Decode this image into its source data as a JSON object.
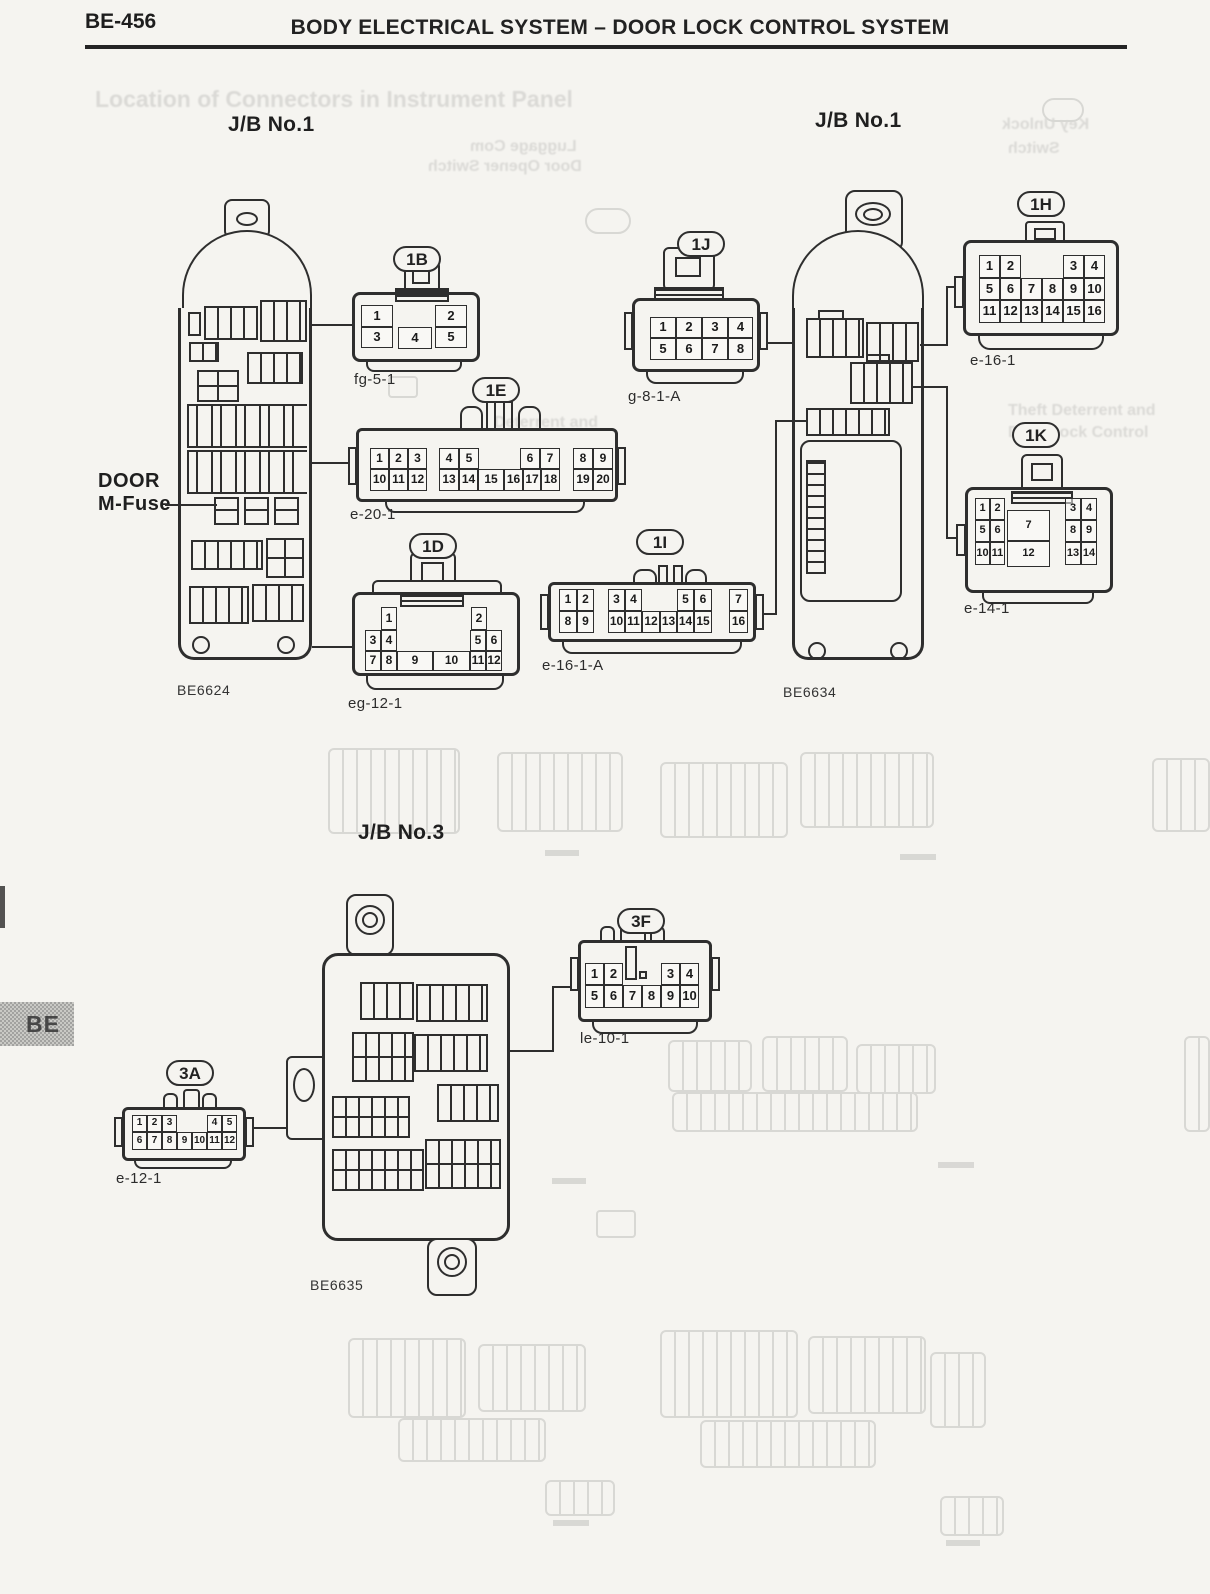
{
  "page": {
    "code": "BE-456",
    "title": "BODY ELECTRICAL SYSTEM – DOOR LOCK CONTROL SYSTEM",
    "side_tab": "BE"
  },
  "sections": {
    "jb1_left": "J/B No.1",
    "jb1_right": "J/B No.1",
    "jb3": "J/B No.3"
  },
  "annotations": {
    "door_mfuse_line1": "DOOR",
    "door_mfuse_line2": "M-Fuse"
  },
  "blocks": {
    "left": {
      "caption": "BE6624"
    },
    "right": {
      "caption": "BE6634"
    },
    "bottom": {
      "caption": "BE6635"
    }
  },
  "connectors": [
    {
      "id": "1B",
      "code": "fg-5-1",
      "pins": [
        [
          "1",
          361,
          305,
          32,
          22
        ],
        [
          "2",
          435,
          305,
          32,
          22
        ],
        [
          "3",
          361,
          327,
          32,
          21
        ],
        [
          "4",
          398,
          327,
          34,
          22
        ],
        [
          "5",
          435,
          327,
          32,
          21
        ]
      ]
    },
    {
      "id": "1E",
      "code": "e-20-1",
      "pins": [
        [
          "1",
          370,
          448,
          19,
          21
        ],
        [
          "2",
          389,
          448,
          19,
          21
        ],
        [
          "3",
          408,
          448,
          19,
          21
        ],
        [
          "4",
          439,
          448,
          20,
          21
        ],
        [
          "5",
          459,
          448,
          20,
          21
        ],
        [
          "6",
          520,
          448,
          20,
          21
        ],
        [
          "7",
          540,
          448,
          20,
          21
        ],
        [
          "8",
          573,
          448,
          20,
          21
        ],
        [
          "9",
          593,
          448,
          20,
          21
        ],
        [
          "10",
          370,
          469,
          19,
          22
        ],
        [
          "11",
          389,
          469,
          19,
          22
        ],
        [
          "12",
          408,
          469,
          19,
          22
        ],
        [
          "13",
          439,
          469,
          20,
          22
        ],
        [
          "14",
          459,
          469,
          19,
          22
        ],
        [
          "15",
          478,
          469,
          26,
          22
        ],
        [
          "16",
          504,
          469,
          19,
          22
        ],
        [
          "17",
          523,
          469,
          18,
          22
        ],
        [
          "18",
          541,
          469,
          19,
          22
        ],
        [
          "19",
          573,
          469,
          20,
          22
        ],
        [
          "20",
          593,
          469,
          20,
          22
        ]
      ]
    },
    {
      "id": "1D",
      "code": "eg-12-1",
      "pins": [
        [
          "1",
          381,
          607,
          16,
          23
        ],
        [
          "2",
          471,
          607,
          16,
          23
        ],
        [
          "3",
          365,
          630,
          16,
          21
        ],
        [
          "4",
          381,
          630,
          16,
          21
        ],
        [
          "5",
          470,
          630,
          16,
          21
        ],
        [
          "6",
          486,
          630,
          16,
          21
        ],
        [
          "7",
          365,
          651,
          16,
          20
        ],
        [
          "8",
          381,
          651,
          16,
          20
        ],
        [
          "9",
          397,
          651,
          36,
          20
        ],
        [
          "10",
          433,
          651,
          37,
          20
        ],
        [
          "11",
          470,
          651,
          16,
          20
        ],
        [
          "12",
          486,
          651,
          16,
          20
        ]
      ]
    },
    {
      "id": "1J",
      "code": "g-8-1-A",
      "pins": [
        [
          "1",
          650,
          317,
          26,
          21
        ],
        [
          "2",
          676,
          317,
          26,
          21
        ],
        [
          "3",
          702,
          317,
          26,
          21
        ],
        [
          "4",
          728,
          317,
          25,
          21
        ],
        [
          "5",
          650,
          338,
          26,
          22
        ],
        [
          "6",
          676,
          338,
          26,
          22
        ],
        [
          "7",
          702,
          338,
          26,
          22
        ],
        [
          "8",
          728,
          338,
          25,
          22
        ]
      ]
    },
    {
      "id": "1I",
      "code": "e-16-1-A",
      "pins": [
        [
          "1",
          559,
          589,
          18,
          22
        ],
        [
          "2",
          577,
          589,
          17,
          22
        ],
        [
          "8",
          559,
          611,
          18,
          22
        ],
        [
          "9",
          577,
          611,
          17,
          22
        ],
        [
          "3",
          608,
          589,
          17,
          22
        ],
        [
          "4",
          625,
          589,
          17,
          22
        ],
        [
          "5",
          677,
          589,
          17,
          22
        ],
        [
          "6",
          694,
          589,
          18,
          22
        ],
        [
          "10",
          608,
          611,
          17,
          22
        ],
        [
          "11",
          625,
          611,
          17,
          22
        ],
        [
          "12",
          642,
          611,
          18,
          22
        ],
        [
          "13",
          660,
          611,
          17,
          22
        ],
        [
          "14",
          677,
          611,
          17,
          22
        ],
        [
          "15",
          694,
          611,
          18,
          22
        ],
        [
          "7",
          729,
          589,
          19,
          22
        ],
        [
          "16",
          729,
          611,
          19,
          22
        ]
      ]
    },
    {
      "id": "1H",
      "code": "e-16-1",
      "pins": [
        [
          "1",
          979,
          255,
          21,
          23
        ],
        [
          "2",
          1000,
          255,
          21,
          23
        ],
        [
          "3",
          1063,
          255,
          21,
          23
        ],
        [
          "4",
          1084,
          255,
          21,
          23
        ],
        [
          "5",
          979,
          278,
          21,
          22
        ],
        [
          "6",
          1000,
          278,
          21,
          22
        ],
        [
          "7",
          1021,
          278,
          21,
          22
        ],
        [
          "8",
          1042,
          278,
          21,
          22
        ],
        [
          "9",
          1063,
          278,
          21,
          22
        ],
        [
          "10",
          1084,
          278,
          21,
          22
        ],
        [
          "11",
          979,
          300,
          21,
          23
        ],
        [
          "12",
          1000,
          300,
          21,
          23
        ],
        [
          "13",
          1021,
          300,
          21,
          23
        ],
        [
          "14",
          1042,
          300,
          21,
          23
        ],
        [
          "15",
          1063,
          300,
          21,
          23
        ],
        [
          "16",
          1084,
          300,
          21,
          23
        ]
      ]
    },
    {
      "id": "1K",
      "code": "e-14-1",
      "pins": [
        [
          "1",
          975,
          498,
          15,
          22
        ],
        [
          "2",
          990,
          498,
          15,
          22
        ],
        [
          "5",
          975,
          520,
          15,
          22
        ],
        [
          "6",
          990,
          520,
          15,
          22
        ],
        [
          "10",
          975,
          542,
          15,
          23
        ],
        [
          "11",
          990,
          542,
          15,
          23
        ],
        [
          "7",
          1007,
          510,
          43,
          31
        ],
        [
          "12",
          1007,
          541,
          43,
          26
        ],
        [
          "3",
          1065,
          498,
          16,
          22
        ],
        [
          "4",
          1081,
          498,
          16,
          22
        ],
        [
          "8",
          1065,
          520,
          16,
          22
        ],
        [
          "9",
          1081,
          520,
          16,
          22
        ],
        [
          "13",
          1065,
          542,
          16,
          23
        ],
        [
          "14",
          1081,
          542,
          16,
          23
        ]
      ]
    },
    {
      "id": "3F",
      "code": "le-10-1",
      "pins": [
        [
          "1",
          585,
          963,
          19,
          22
        ],
        [
          "2",
          604,
          963,
          19,
          22
        ],
        [
          "3",
          661,
          963,
          19,
          22
        ],
        [
          "4",
          680,
          963,
          19,
          22
        ],
        [
          "5",
          585,
          985,
          19,
          23
        ],
        [
          "6",
          604,
          985,
          19,
          23
        ],
        [
          "7",
          623,
          985,
          19,
          23
        ],
        [
          "8",
          642,
          985,
          19,
          23
        ],
        [
          "9",
          661,
          985,
          19,
          23
        ],
        [
          "10",
          680,
          985,
          19,
          23
        ]
      ]
    },
    {
      "id": "3A",
      "code": "e-12-1",
      "pins": [
        [
          "1",
          132,
          1115,
          15,
          17
        ],
        [
          "2",
          147,
          1115,
          15,
          17
        ],
        [
          "3",
          162,
          1115,
          15,
          17
        ],
        [
          "4",
          207,
          1115,
          15,
          17
        ],
        [
          "5",
          222,
          1115,
          15,
          17
        ],
        [
          "6",
          132,
          1132,
          15,
          18
        ],
        [
          "7",
          147,
          1132,
          15,
          18
        ],
        [
          "8",
          162,
          1132,
          15,
          18
        ],
        [
          "9",
          177,
          1132,
          15,
          18
        ],
        [
          "10",
          192,
          1132,
          15,
          18
        ],
        [
          "11",
          207,
          1132,
          15,
          18
        ],
        [
          "12",
          222,
          1132,
          15,
          18
        ]
      ]
    }
  ],
  "ghost": {
    "items": [
      [
        "Location of Connectors in Instrument Panel",
        95,
        86,
        23,
        0
      ],
      [
        "Luggage Com",
        470,
        138,
        16,
        1
      ],
      [
        "Door Opener Switch",
        428,
        158,
        16,
        1
      ],
      [
        "Key Unlock",
        1002,
        116,
        16,
        1
      ],
      [
        "Switch",
        1008,
        140,
        16,
        1
      ],
      [
        "Theft Deterrent and",
        1008,
        402,
        16,
        0
      ],
      [
        "Door Lock Control",
        1008,
        424,
        16,
        0
      ],
      [
        "Deterrent and",
        494,
        414,
        16,
        0
      ]
    ]
  }
}
